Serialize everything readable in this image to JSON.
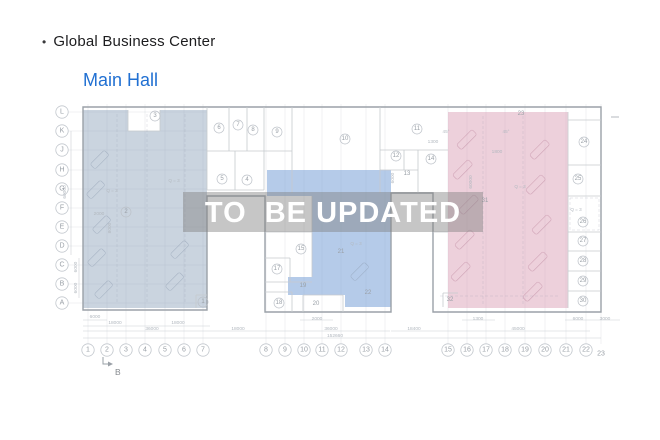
{
  "header": {
    "bullet": "•",
    "title": "Global Business Center",
    "subtitle": "Main Hall"
  },
  "banner": {
    "text": "TO  BE UPDATED"
  },
  "colors": {
    "title_text": "#1d1d1f",
    "subtitle_blue": "#2170d2",
    "left_region": "rgba(150,170,192,0.5)",
    "center_region": "rgba(120,160,215,0.55)",
    "right_region": "rgba(215,150,175,0.45)",
    "banner_bg": "rgba(128,128,128,0.45)",
    "banner_text_color": "#ffffff",
    "wall_gray": "#9ba1a8"
  },
  "plan": {
    "row_labels": [
      {
        "label": "L",
        "y": 112
      },
      {
        "label": "K",
        "y": 131
      },
      {
        "label": "J",
        "y": 150
      },
      {
        "label": "H",
        "y": 170
      },
      {
        "label": "G",
        "y": 189
      },
      {
        "label": "F",
        "y": 208
      },
      {
        "label": "E",
        "y": 227
      },
      {
        "label": "D",
        "y": 246
      },
      {
        "label": "C",
        "y": 265
      },
      {
        "label": "B",
        "y": 284
      },
      {
        "label": "A",
        "y": 303
      }
    ],
    "col_labels": [
      {
        "label": "1",
        "x": 88
      },
      {
        "label": "2",
        "x": 107
      },
      {
        "label": "3",
        "x": 126
      },
      {
        "label": "4",
        "x": 145
      },
      {
        "label": "5",
        "x": 165
      },
      {
        "label": "6",
        "x": 184
      },
      {
        "label": "7",
        "x": 203
      },
      {
        "label": "8",
        "x": 266
      },
      {
        "label": "9",
        "x": 285
      },
      {
        "label": "10",
        "x": 304
      },
      {
        "label": "11",
        "x": 322
      },
      {
        "label": "12",
        "x": 341
      },
      {
        "label": "13",
        "x": 366
      },
      {
        "label": "14",
        "x": 385
      },
      {
        "label": "15",
        "x": 448
      },
      {
        "label": "16",
        "x": 467
      },
      {
        "label": "17",
        "x": 486
      },
      {
        "label": "18",
        "x": 505
      },
      {
        "label": "19",
        "x": 525
      },
      {
        "label": "20",
        "x": 545
      },
      {
        "label": "21",
        "x": 566
      },
      {
        "label": "22",
        "x": 586
      },
      {
        "label": "23",
        "x": 601,
        "y": 354,
        "circle": false
      }
    ],
    "rooms": [
      {
        "label": "3",
        "x": 155,
        "y": 116
      },
      {
        "label": "2",
        "x": 126,
        "y": 212
      },
      {
        "label": "1",
        "x": 203,
        "y": 302
      },
      {
        "label": "6",
        "x": 219,
        "y": 128
      },
      {
        "label": "7",
        "x": 238,
        "y": 125
      },
      {
        "label": "8",
        "x": 253,
        "y": 130
      },
      {
        "label": "9",
        "x": 277,
        "y": 132
      },
      {
        "label": "5",
        "x": 222,
        "y": 179
      },
      {
        "label": "4",
        "x": 247,
        "y": 180
      },
      {
        "label": "10",
        "x": 345,
        "y": 139
      },
      {
        "label": "11",
        "x": 417,
        "y": 129
      },
      {
        "label": "12",
        "x": 396,
        "y": 156
      },
      {
        "label": "13",
        "x": 407,
        "y": 174,
        "circle": false
      },
      {
        "label": "14",
        "x": 431,
        "y": 159
      },
      {
        "label": "15",
        "x": 301,
        "y": 249
      },
      {
        "label": "17",
        "x": 277,
        "y": 269
      },
      {
        "label": "18",
        "x": 279,
        "y": 303
      },
      {
        "label": "19",
        "x": 303,
        "y": 286,
        "circle": false
      },
      {
        "label": "20",
        "x": 316,
        "y": 304,
        "circle": false
      },
      {
        "label": "21",
        "x": 341,
        "y": 252,
        "circle": false
      },
      {
        "label": "22",
        "x": 368,
        "y": 293,
        "circle": false
      },
      {
        "label": "23",
        "x": 521,
        "y": 114,
        "circle": false
      },
      {
        "label": "24",
        "x": 584,
        "y": 142
      },
      {
        "label": "25",
        "x": 578,
        "y": 179
      },
      {
        "label": "26",
        "x": 583,
        "y": 222
      },
      {
        "label": "27",
        "x": 583,
        "y": 241
      },
      {
        "label": "28",
        "x": 583,
        "y": 261
      },
      {
        "label": "29",
        "x": 583,
        "y": 281
      },
      {
        "label": "30",
        "x": 583,
        "y": 301
      },
      {
        "label": "31",
        "x": 485,
        "y": 201,
        "circle": false
      },
      {
        "label": "32",
        "x": 450,
        "y": 300,
        "circle": false
      }
    ],
    "dimensions": [
      {
        "text": "6000",
        "x": 95,
        "y": 318
      },
      {
        "text": "18000",
        "x": 115,
        "y": 324
      },
      {
        "text": "36000",
        "x": 152,
        "y": 330
      },
      {
        "text": "18000",
        "x": 178,
        "y": 324
      },
      {
        "text": "18000",
        "x": 238,
        "y": 330
      },
      {
        "text": "2000",
        "x": 317,
        "y": 320
      },
      {
        "text": "36000",
        "x": 331,
        "y": 330
      },
      {
        "text": "152660",
        "x": 335,
        "y": 337
      },
      {
        "text": "18400",
        "x": 414,
        "y": 330
      },
      {
        "text": "1300",
        "x": 478,
        "y": 320
      },
      {
        "text": "45000",
        "x": 518,
        "y": 330
      },
      {
        "text": "6000",
        "x": 578,
        "y": 320
      },
      {
        "text": "3000",
        "x": 605,
        "y": 320
      },
      {
        "text": "60000",
        "x": 66,
        "y": 192,
        "rotate": -90
      },
      {
        "text": "6000",
        "x": 77,
        "y": 267,
        "rotate": -90
      },
      {
        "text": "6000",
        "x": 77,
        "y": 288,
        "rotate": -90
      },
      {
        "text": "60000",
        "x": 472,
        "y": 182,
        "rotate": -90
      },
      {
        "text": "6000",
        "x": 394,
        "y": 178,
        "rotate": -90
      },
      {
        "text": "8000",
        "x": 111,
        "y": 228,
        "rotate": -90
      },
      {
        "text": "2000",
        "x": 99,
        "y": 215
      },
      {
        "text": "1300",
        "x": 433,
        "y": 143
      },
      {
        "text": "1800",
        "x": 497,
        "y": 153
      }
    ],
    "notes": [
      {
        "text": "Q = 3",
        "x": 112,
        "y": 192
      },
      {
        "text": "Q = 3",
        "x": 174,
        "y": 182
      },
      {
        "text": "Q = 3",
        "x": 356,
        "y": 245
      },
      {
        "text": "Q = 3",
        "x": 520,
        "y": 188
      },
      {
        "text": "Q = 3",
        "x": 576,
        "y": 211
      },
      {
        "text": "45°",
        "x": 446,
        "y": 133
      },
      {
        "text": "45°",
        "x": 506,
        "y": 133
      }
    ],
    "section_marker": {
      "label": "B"
    }
  }
}
